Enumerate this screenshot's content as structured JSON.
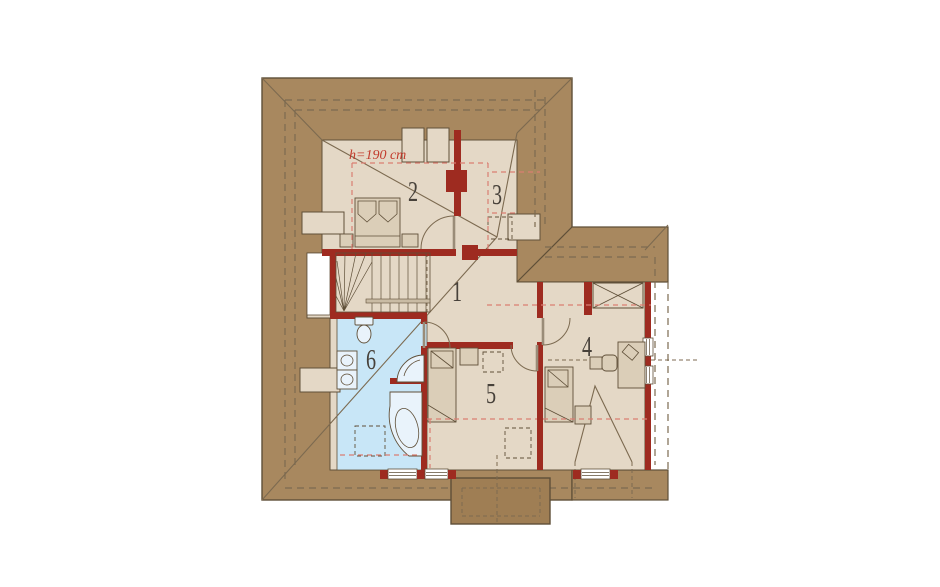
{
  "annotations": {
    "height_note": "h=190 cm"
  },
  "rooms": [
    {
      "label": "1"
    },
    {
      "label": "2"
    },
    {
      "label": "3"
    },
    {
      "label": "4"
    },
    {
      "label": "5"
    },
    {
      "label": "6"
    }
  ],
  "colors": {
    "roof_brown": "#a8885f",
    "porch_brown": "#9f7e54",
    "floor_beige": "#e4d8c6",
    "furn_beige": "#dbceb8",
    "bath_blue": "#c8e6f7",
    "fixture_fill": "#e9f3fb",
    "wall_red": "#9e2b20",
    "dash_red": "#d97e72",
    "accent_red": "#c23a2b",
    "line_dark": "#5f4f38",
    "line_mid": "#7c6a50",
    "text_dark": "#47413a"
  }
}
